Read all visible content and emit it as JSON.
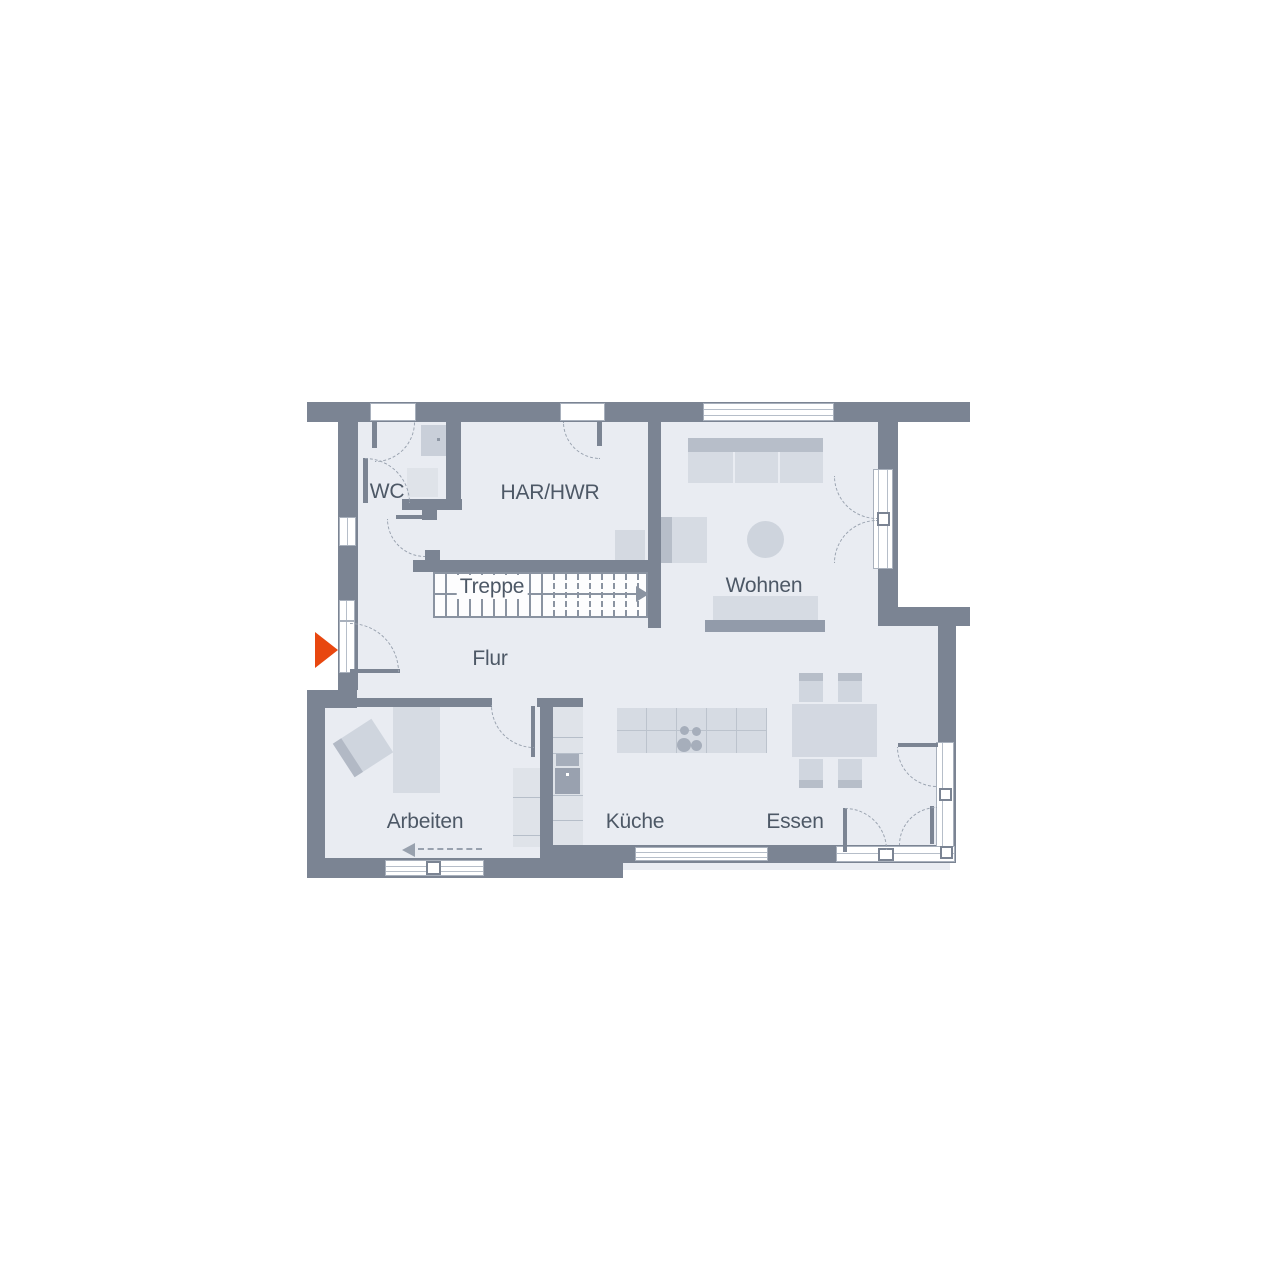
{
  "rooms": {
    "wc": "WC",
    "har_hwr": "HAR/HWR",
    "treppe": "Treppe",
    "wohnen": "Wohnen",
    "flur": "Flur",
    "arbeiten": "Arbeiten",
    "kueche": "Küche",
    "essen": "Essen"
  },
  "stairs": {
    "label": "Treppe",
    "solid_treads": 9,
    "dashed_treads": 8,
    "direction_arrow": "right"
  },
  "entrance": {
    "marker": "orange-triangle-arrow",
    "direction": "right",
    "color": "#e8470f"
  },
  "colors": {
    "wall": "#7b8493",
    "floor": "#e9ecf2",
    "furniture_light": "#d6dbe3",
    "furniture_dark": "#b7bec9",
    "appliance": "#99a1af",
    "stair_lines": "#8a93a1",
    "text": "#4d5866",
    "accent": "#e8470f"
  }
}
